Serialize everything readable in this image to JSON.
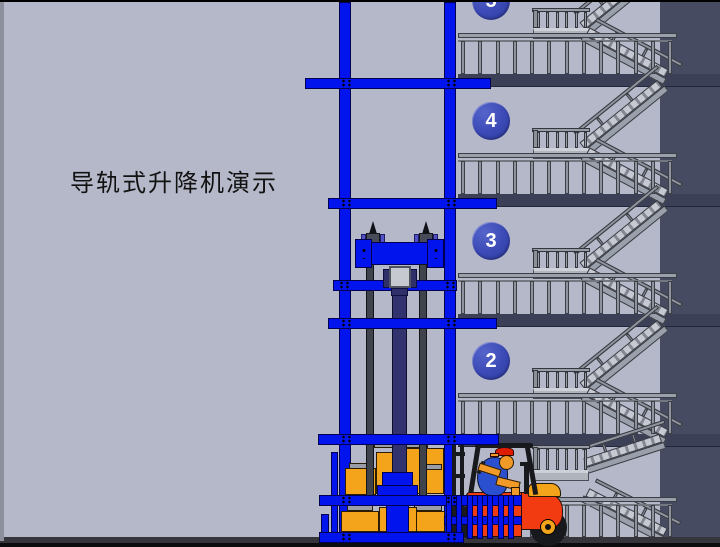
{
  "app": {
    "title_text": "导轨式升降机演示"
  },
  "floors": [
    {
      "label": "5"
    },
    {
      "label": "4"
    },
    {
      "label": "3"
    },
    {
      "label": "2"
    }
  ],
  "colors": {
    "background": "#b5b8c8",
    "wall_dark": "#474b62",
    "floor_slab": "#3c4057",
    "frame_blue": "#0114ee",
    "floor_badge_blue": "#3847b2",
    "stair_gray": "#9aa0ab",
    "cargo_orange": "#f4a41a",
    "forklift_red": "#f23b11",
    "driver_shirt_blue": "#2a50d0",
    "driver_tan": "#f29a28",
    "driver_cap_red": "#e01c00"
  }
}
